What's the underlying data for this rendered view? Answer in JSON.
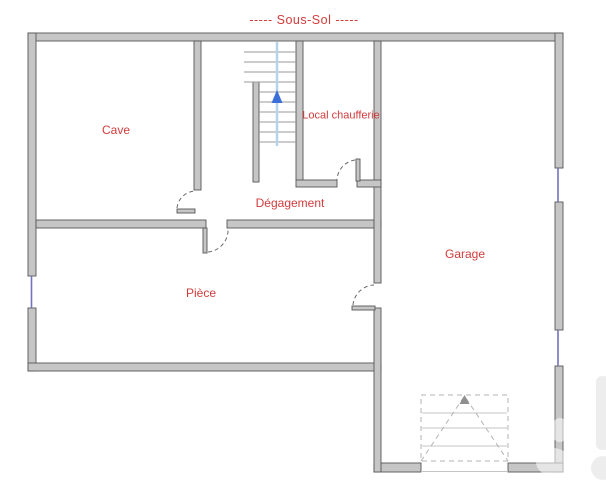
{
  "plan": {
    "title": "----- Sous-Sol -----",
    "floor_name": "Sous-Sol"
  },
  "rooms": {
    "cave": {
      "label": "Cave"
    },
    "chaufferie": {
      "label": "Local chaufferie"
    },
    "degagement": {
      "label": "Dégagement"
    },
    "piece": {
      "label": "Pièce"
    },
    "garage": {
      "label": "Garage"
    }
  },
  "symbols": {
    "stair_direction": "up-arrow",
    "doors": [
      "cave-door",
      "degagement-piece-door",
      "chaufferie-door",
      "piece-garage-door",
      "garage-sectional-door"
    ],
    "windows": [
      "left-wall-window",
      "right-wall-window-upper",
      "right-wall-window-lower"
    ]
  },
  "colors": {
    "label_color": "#d23b3b",
    "wall_fill": "#c6c6c6",
    "wall_stroke": "#565656",
    "window_color": "#7373bb",
    "stair_line": "#b5d3ea",
    "stair_arrow": "#3a6fd8"
  }
}
